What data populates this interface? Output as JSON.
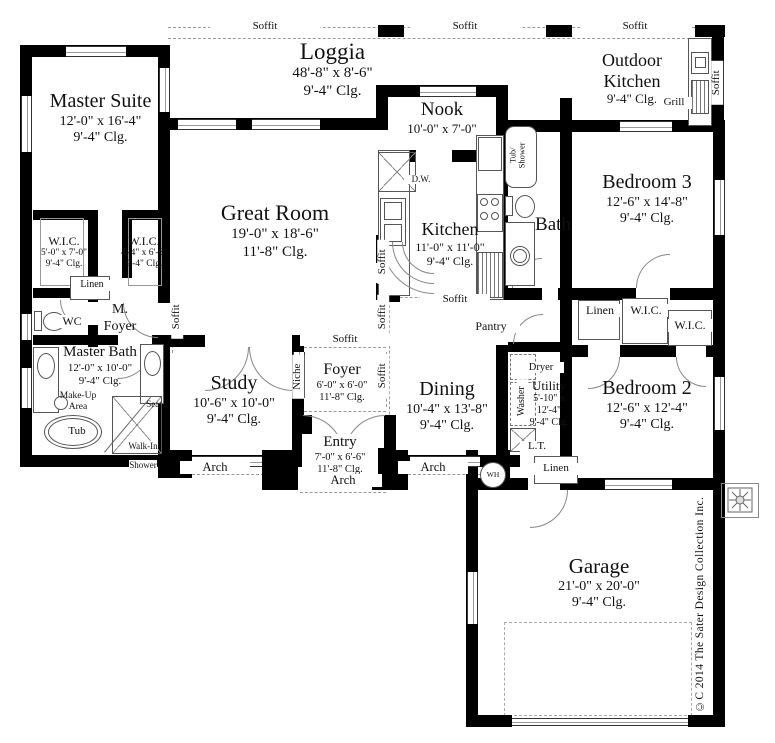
{
  "rooms": {
    "master_suite": {
      "name": "Master Suite",
      "dims": "12'-0\" x 16'-4\"",
      "clg": "9'-4\" Clg."
    },
    "loggia": {
      "name": "Loggia",
      "dims": "48'-8\" x 8'-6\"",
      "clg": "9'-4\" Clg."
    },
    "outdoor_kitchen": {
      "name": "Outdoor Kitchen",
      "clg": "9'-4\" Clg."
    },
    "nook": {
      "name": "Nook",
      "dims": "10'-0\" x 7'-0\""
    },
    "great_room": {
      "name": "Great Room",
      "dims": "19'-0\" x 18'-6\"",
      "clg": "11'-8\" Clg."
    },
    "kitchen": {
      "name": "Kitchen",
      "dims": "11'-0\" x 11'-0\"",
      "clg": "9'-4\" Clg."
    },
    "bath": {
      "name": "Bath"
    },
    "bedroom3": {
      "name": "Bedroom 3",
      "dims": "12'-6\" x 14'-8\"",
      "clg": "9'-4\" Clg."
    },
    "wic_master_1": {
      "name": "W.I.C.",
      "dims": "5'-0\" x 7'-0\"",
      "clg": "9'-4\" Clg."
    },
    "wic_master_2": {
      "name": "W.I.C.",
      "dims": "4'-4\" x 6'-6\"",
      "clg": "9'-4\" Clg."
    },
    "m_foyer": {
      "l1": "M.",
      "l2": "Foyer"
    },
    "wc": {
      "name": "WC"
    },
    "master_bath": {
      "name": "Master Bath",
      "dims": "12'-0\" x 10'-0\"",
      "clg": "9'-4\" Clg."
    },
    "study": {
      "name": "Study",
      "dims": "10'-6\" x 10'-0\"",
      "clg": "9'-4\" Clg."
    },
    "foyer": {
      "name": "Foyer",
      "dims": "6'-0\" x 6'-0\"",
      "clg": "11'-8\" Clg."
    },
    "entry": {
      "name": "Entry",
      "dims": "7'-0\" x 6'-6\"",
      "clg": "11'-8\" Clg."
    },
    "dining": {
      "name": "Dining",
      "dims": "10'-4\" x 13'-8\"",
      "clg": "9'-4\" Clg."
    },
    "pantry": {
      "name": "Pantry"
    },
    "utility": {
      "name": "Utility",
      "dims": "5'-10\" x 12'-4\"",
      "clg": "9'-4\" Clg."
    },
    "bedroom2": {
      "name": "Bedroom 2",
      "dims": "12'-6\" x 12'-4\"",
      "clg": "9'-4\" Clg."
    },
    "garage": {
      "name": "Garage",
      "dims": "21'-0\" x 20'-0\"",
      "clg": "9'-4\" Clg."
    },
    "wic_hall_1": {
      "name": "W.I.C."
    },
    "wic_hall_2": {
      "name": "W.I.C."
    }
  },
  "labels": {
    "soffit": "Soffit",
    "arch": "Arch",
    "niche": "Niche",
    "linen": "Linen",
    "dryer": "Dryer",
    "washer": "Washer",
    "lt": "L.T.",
    "wh": "WH",
    "dw": "D.W.",
    "grill": "Grill",
    "tub": "Tub",
    "seat": "Seat",
    "makeup": {
      "l1": "Make-Up",
      "l2": "Area"
    },
    "walkin": {
      "l1": "Walk-In",
      "l2": "Shower"
    },
    "tub_shower": {
      "l1": "Tub/",
      "l2": "Shower"
    }
  },
  "copyright": "©C 2014 The Sater Design Collection Inc."
}
